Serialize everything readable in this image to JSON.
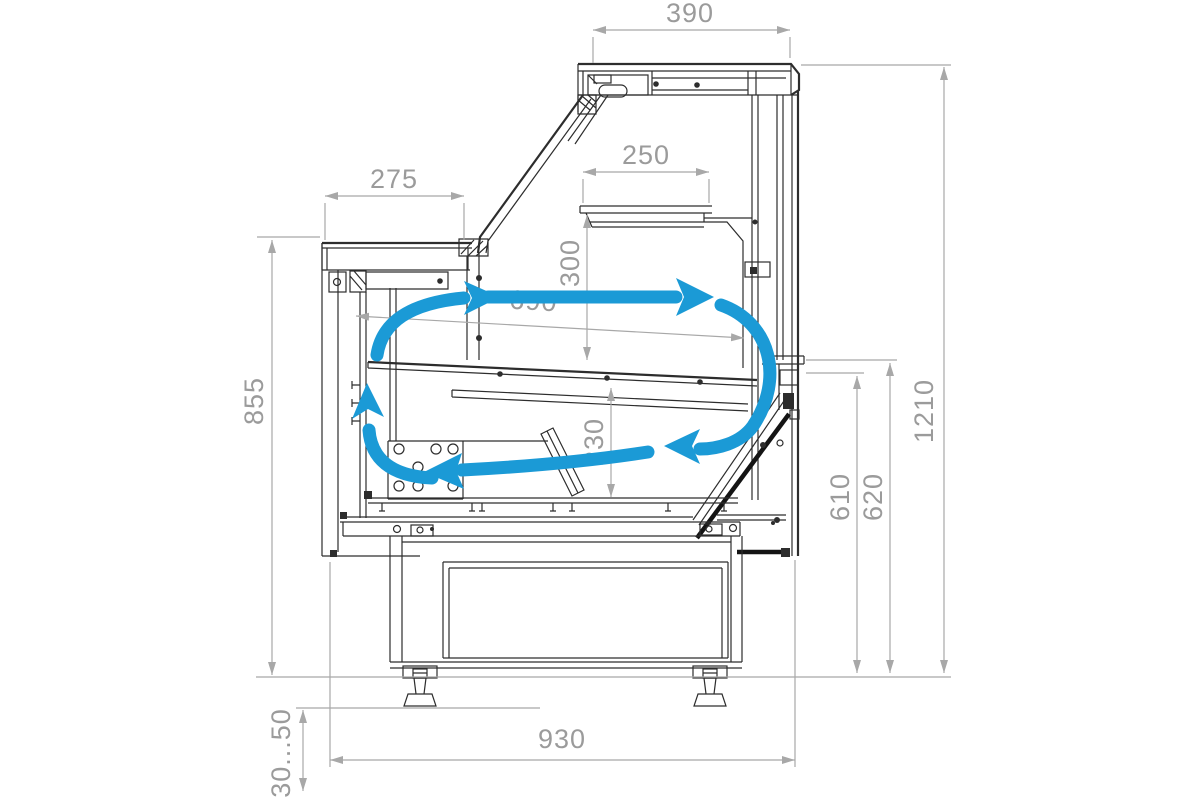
{
  "colors": {
    "line": "#2d2d2d",
    "dimension": "#9b9b9b",
    "airflow_accent": "#1b9ad6",
    "background": "#ffffff"
  },
  "dimensions": {
    "canopy_width": "390",
    "counter_depth": "275",
    "shelf_depth": "250",
    "shelf_to_deck": "300",
    "deck_length": "690",
    "well_depth": "230",
    "front_height": "855",
    "board_height_inner": "610",
    "board_height_outer": "620",
    "total_height": "1210",
    "base_width": "930",
    "leg_adjustment": "30...50"
  }
}
